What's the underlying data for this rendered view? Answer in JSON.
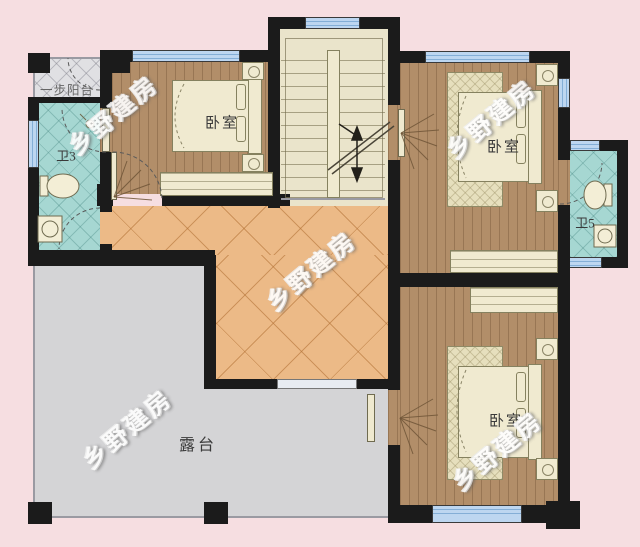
{
  "watermark": {
    "text": "乡野建房"
  },
  "rooms": {
    "balcony": {
      "label": "一步阳台"
    },
    "bathroom_left": {
      "label": "卫3"
    },
    "bedroom_top_left": {
      "label": "卧室"
    },
    "bedroom_top_right": {
      "label": "卧室"
    },
    "bedroom_bottom_right": {
      "label": "卧室"
    },
    "bathroom_right": {
      "label": "卫5"
    },
    "terrace": {
      "label": "露台"
    }
  },
  "colors": {
    "background": "#f6dee1",
    "wall": "#1b1b1b",
    "window": "#bdd6f0",
    "wood_floor": "#b28e69",
    "hallway_tile": "#ecba87",
    "bathroom_tile": "#a6d7d2",
    "terrace": "#d4d4d6",
    "balcony": "#e0e0e3",
    "stairs": "#eae4cb"
  }
}
